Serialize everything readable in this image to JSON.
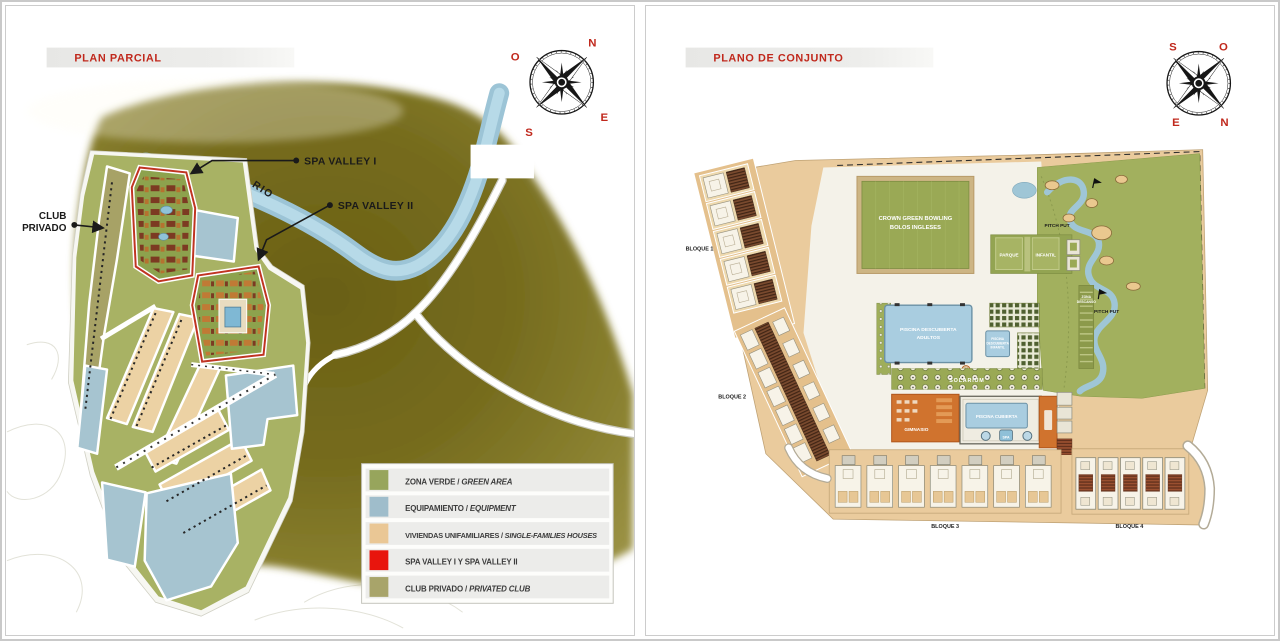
{
  "page": {
    "background": "#ffffff",
    "accent_red": "#c0281c"
  },
  "left_panel": {
    "title": "PLAN PARCIAL",
    "compass": {
      "n": "N",
      "o": "O",
      "e": "E",
      "s": "S"
    },
    "map_labels": {
      "spa_valley_1": "SPA VALLEY I",
      "spa_valley_2": "SPA VALLEY II",
      "club_privado_line1": "CLUB",
      "club_privado_line2": "PRIVADO",
      "rio": "RIO"
    },
    "legend": {
      "items": [
        {
          "color": "#97a55c",
          "label_es": "ZONA VERDE / ",
          "label_en": "GREEN AREA"
        },
        {
          "color": "#9fbdcb",
          "label_es": "EQUIPAMIENTO / ",
          "label_en": "EQUIPMENT"
        },
        {
          "color": "#eac795",
          "label_es": "VIVIENDAS UNIFAMILIARES / ",
          "label_en": "SINGLE-FAMILIES HOUSES"
        },
        {
          "color": "#e8150d",
          "label_es": "SPA VALLEY I Y SPA VALLEY II",
          "label_en": ""
        },
        {
          "color": "#a8a46a",
          "label_es": "CLUB PRIVADO / ",
          "label_en": "PRIVATED CLUB"
        }
      ]
    }
  },
  "right_panel": {
    "title": "PLANO DE CONJUNTO",
    "compass": {
      "n": "N",
      "o": "O",
      "e": "E",
      "s": "S"
    },
    "map_labels": {
      "bloque_1": "BLOQUE 1",
      "bloque_2": "BLOQUE 2",
      "bloque_3": "BLOQUE 3",
      "bloque_4": "BLOQUE 4",
      "bowling_line1": "CROWN GREEN BOWLING",
      "bowling_line2": "BOLOS INGLESES",
      "parque_line1": "PARQUE",
      "parque_line2": "INFANTIL",
      "piscina_adultos_line1": "PISCINA DESCUBIERTA",
      "piscina_adultos_line2": "ADULTOS",
      "piscina_infantil_line1": "PISCINA",
      "piscina_infantil_line2": "DESCUBIERTA",
      "piscina_infantil_line3": "INFANTIL",
      "solarium": "SOLARIUM",
      "gimnasio": "GIMNASIO",
      "piscina_cubierta": "PISCINA CUBIERTA",
      "spa": "SPA",
      "pitch_put_upper": "PITCH PUT",
      "pitch_put_lower": "PITCH PUT",
      "zona_descanso_line1": "ZONA",
      "zona_descanso_line2": "DESCANSO"
    }
  }
}
